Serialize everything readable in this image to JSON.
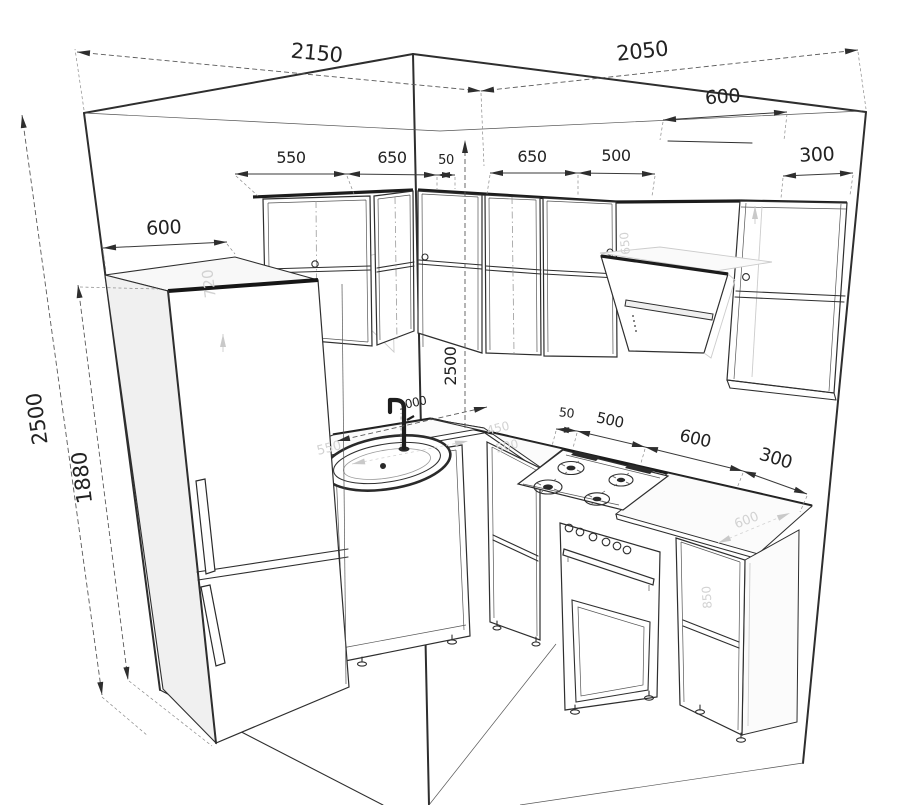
{
  "drawing": {
    "background_color": "#ffffff",
    "ink_color": "#2e2e2e",
    "ghost_color": "#d2d2d2",
    "dimensions": {
      "wall_left_length": "2150",
      "wall_right_length": "2050",
      "hood_width": "600",
      "upper_right_depth": "300",
      "upper_left_cab1": "550",
      "upper_left_cab2": "650",
      "upper_left_gap": "50",
      "upper_right_cab1": "650",
      "upper_right_cab2": "500",
      "fridge_depth": "600",
      "wall_height": "2500",
      "fridge_height": "1880",
      "corner_wall_height": "2500",
      "faucet_offset": "1000",
      "base_gap": "50",
      "base_cab1": "500",
      "base_cab2": "600",
      "base_cab3": "300"
    },
    "ghost_labels": {
      "upper_cabinet_height": "720",
      "left_counter": "550",
      "corner_counter_a": "450",
      "corner_counter_b": "500",
      "upper_right_interior": "650",
      "right_counter_depth": "600",
      "base_cabinet_height": "850"
    }
  }
}
